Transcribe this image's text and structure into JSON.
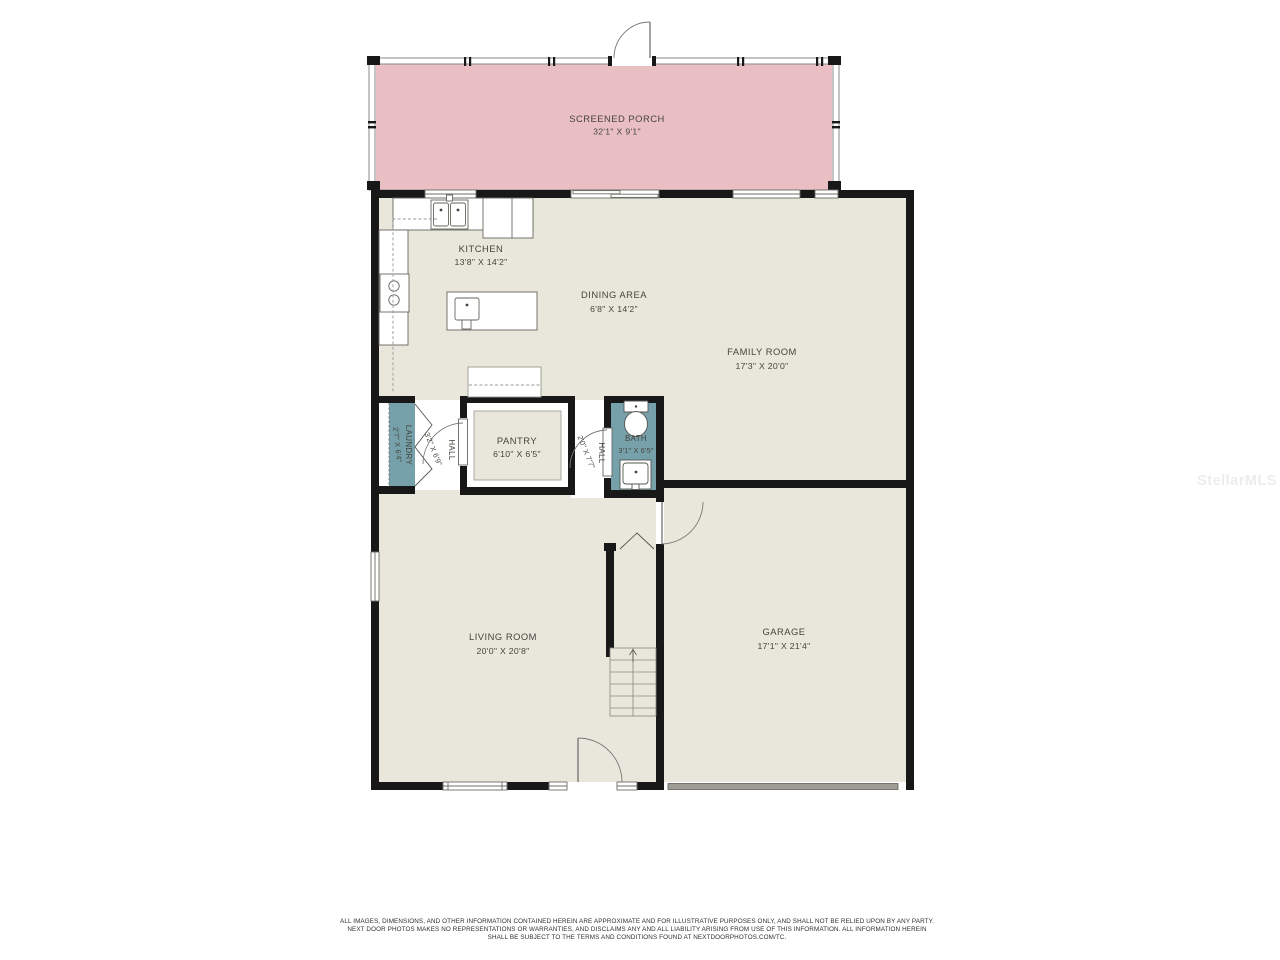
{
  "watermark": "StellarMLS",
  "colors": {
    "floor": "#e9e7dc",
    "porch": "#eabfc4",
    "wet_room": "#76a0aa",
    "wall": "#181818",
    "garage_door": "#9d9d96"
  },
  "rooms": {
    "screened_porch": {
      "name": "SCREENED PORCH",
      "dims": "32'1\" X 9'1\""
    },
    "kitchen": {
      "name": "KITCHEN",
      "dims": "13'8\" X 14'2\""
    },
    "dining": {
      "name": "DINING AREA",
      "dims": "6'8\" X 14'2\""
    },
    "family": {
      "name": "FAMILY ROOM",
      "dims": "17'3\" X 20'0\""
    },
    "laundry": {
      "name": "LAUNDRY",
      "dims": "2'7\" X 6'4\""
    },
    "hall1": {
      "name": "HALL",
      "dims": "3'2\" X 6'9\""
    },
    "pantry": {
      "name": "PANTRY",
      "dims": "6'10\" X 6'5\""
    },
    "hall2": {
      "name": "HALL",
      "dims": "2'0\" X 7'7\""
    },
    "bath": {
      "name": "BATH",
      "dims": "3'1\" X 6'5\""
    },
    "living": {
      "name": "LIVING ROOM",
      "dims": "20'0\" X 20'8\""
    },
    "garage": {
      "name": "GARAGE",
      "dims": "17'1\" X 21'4\""
    }
  },
  "disclaimer": {
    "line1": "ALL IMAGES, DIMENSIONS, AND OTHER INFORMATION CONTAINED HEREIN ARE APPROXIMATE AND FOR ILLUSTRATIVE PURPOSES ONLY, AND SHALL NOT BE RELIED UPON BY ANY PARTY.",
    "line2": "NEXT DOOR PHOTOS MAKES NO REPRESENTATIONS OR WARRANTIES, AND DISCLAIMS ANY AND ALL LIABILITY ARISING FROM USE OF THIS INFORMATION. ALL INFORMATION HEREIN",
    "line3": "SHALL BE SUBJECT TO THE TERMS AND CONDITIONS FOUND AT NEXTDOORPHOTOS.COM/TC."
  }
}
